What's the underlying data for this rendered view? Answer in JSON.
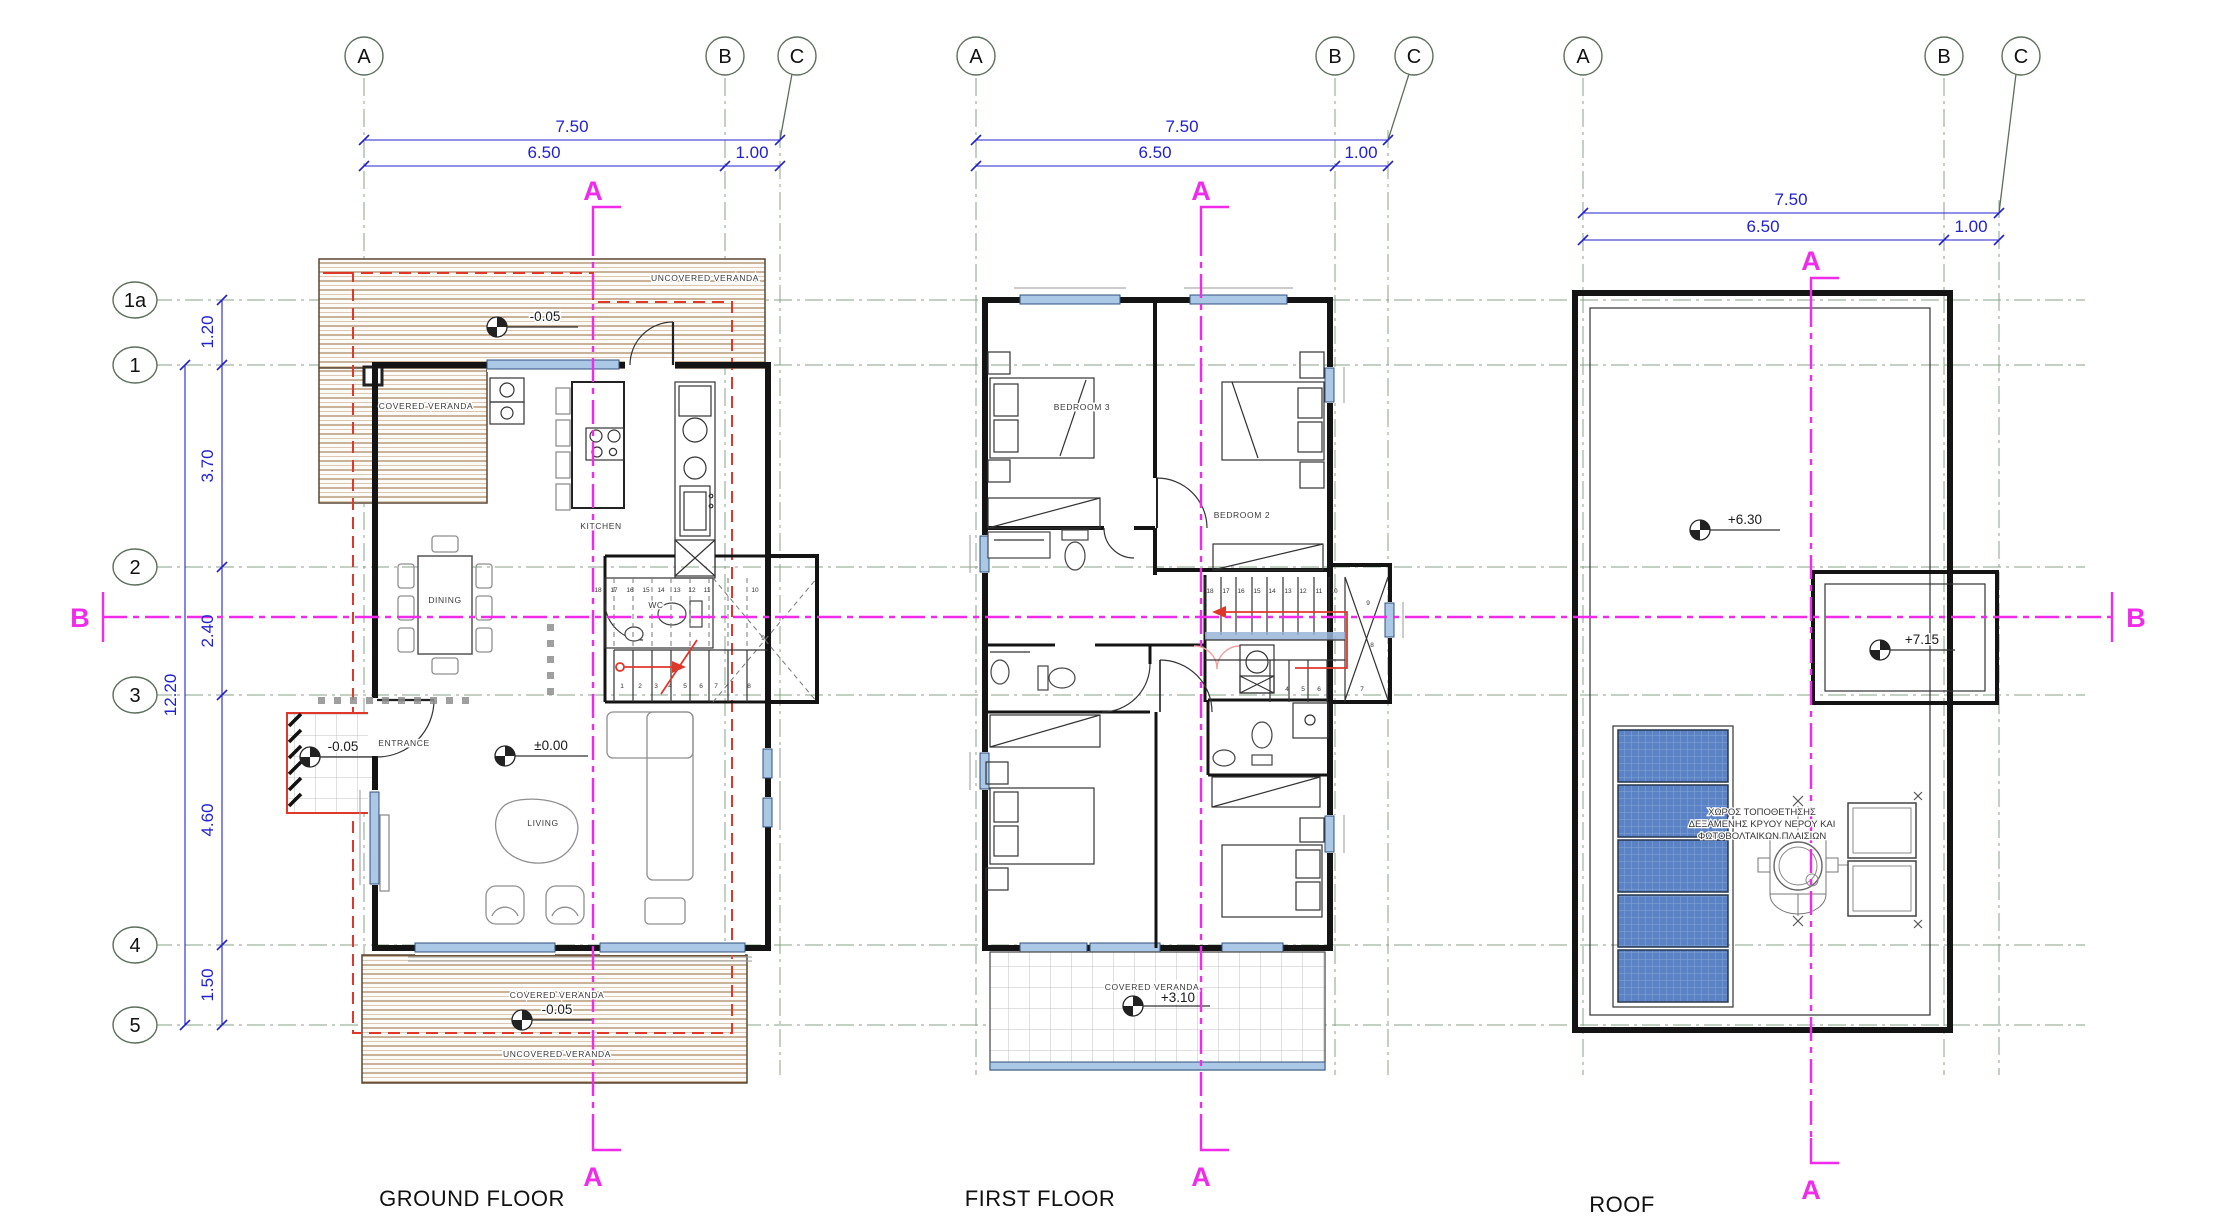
{
  "colors": {
    "dimension_blue": "#2222cc",
    "section_magenta": "#f02bea",
    "overhang_red": "#e0372b",
    "deck_brown": "#a5815c",
    "grid_green": "#8aa08a",
    "window_blue": "#abc8e6",
    "solar_blue": "#5b82c4"
  },
  "grid": {
    "cols": [
      "A",
      "B",
      "C"
    ],
    "rows": [
      "1a",
      "1",
      "2",
      "3",
      "4",
      "5"
    ]
  },
  "dims": {
    "top_total": "7.50",
    "top_main": "6.50",
    "top_side": "1.00",
    "left_segments": [
      "1.20",
      "3.70",
      "2.40",
      "4.60",
      "1.50"
    ],
    "left_total": "12.20"
  },
  "sections": {
    "a": "A",
    "b": "B"
  },
  "plans": {
    "ground": {
      "title": "GROUND FLOOR",
      "labels": {
        "uncovered_top": "UNCOVERED VERANDA",
        "covered_top": "COVERED VERANDA",
        "kitchen": "KITCHEN",
        "dining": "DINING",
        "wc": "WC",
        "entrance": "ENTRANCE",
        "living": "LIVING",
        "covered_bottom": "COVERED VERANDA",
        "uncovered_bottom": "UNCOVERED VERANDA"
      },
      "levels": {
        "veranda_top": "-0.05",
        "porch": "-0.05",
        "floor": "±0.00",
        "veranda_bottom": "-0.05"
      },
      "stairs": {
        "upper": [
          "18",
          "17",
          "16",
          "15",
          "14",
          "13",
          "12",
          "11"
        ],
        "winder_top": "10",
        "winder_mid": "9",
        "winder_low": "8",
        "lower": [
          "1",
          "2",
          "3",
          "4",
          "5",
          "6",
          "7"
        ]
      }
    },
    "first": {
      "title": "FIRST FLOOR",
      "labels": {
        "bedroom3": "BEDROOM 3",
        "bedroom2": "BEDROOM 2",
        "covered": "COVERED VERANDA"
      },
      "levels": {
        "veranda": "+3.10"
      },
      "stairs": {
        "upper": [
          "18",
          "17",
          "16",
          "15",
          "14",
          "13",
          "12",
          "11",
          "10"
        ],
        "side": [
          "9",
          "8"
        ],
        "lower": [
          "4",
          "5",
          "6",
          "7"
        ]
      }
    },
    "roof": {
      "title": "ROOF",
      "levels": {
        "main": "+6.30",
        "annex": "+7.15"
      },
      "note": [
        "ΧΩΡΟΣ ΤΟΠΟΘΕΤΗΣΗΣ",
        "ΔΕΞΑΜΕΝΗΣ ΚΡΥΟΥ ΝΕΡΟΥ ΚΑΙ",
        "ΦΩΤΟΒΟΛΤΑΙΚΩΝ ΠΛΑΙΣΙΩΝ"
      ]
    }
  }
}
